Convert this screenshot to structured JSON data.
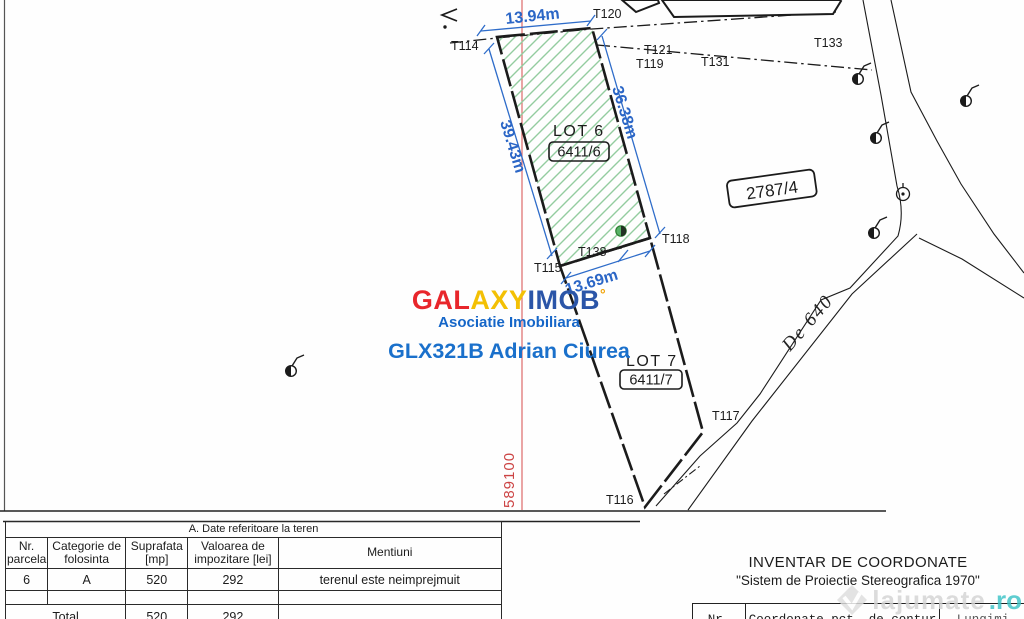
{
  "map": {
    "points": [
      {
        "id": "T114"
      },
      {
        "id": "T120"
      },
      {
        "id": "T121"
      },
      {
        "id": "T119"
      },
      {
        "id": "T131"
      },
      {
        "id": "T133"
      },
      {
        "id": "T138"
      },
      {
        "id": "T118"
      },
      {
        "id": "T115"
      },
      {
        "id": "T116"
      },
      {
        "id": "T117"
      }
    ],
    "dimensions": {
      "top": "13.94m",
      "left": "39.43m",
      "right": "36.38m",
      "bottom": "13.69m"
    },
    "lot6_label": "LOT 6",
    "lot6_parcel": "6411/6",
    "lot7_label": "LOT 7",
    "lot7_parcel": "6411/7",
    "parcel_right": "2787/4",
    "road_name": "De 640",
    "grid_coordinate": "589100"
  },
  "colors": {
    "hatch_green": "#93cc9f",
    "dimension_blue": "#2b66c6",
    "grid_red": "#cc4444",
    "brand_red": "#e8262b",
    "brand_yellow": "#f3c004",
    "brand_blue": "#2b55a8",
    "watermark_teal": "#3cc3c6"
  },
  "watermark": {
    "brand": [
      {
        "text": "GAL",
        "color": "#e8262b"
      },
      {
        "text": "AXY",
        "color": "#f3c004"
      },
      {
        "text": "IMOB",
        "color": "#2b55a8"
      }
    ],
    "brand_mark": "°",
    "subtitle": "Asociatie Imobiliara",
    "agent_code": "GLX321B Adrian Ciurea"
  },
  "land_table": {
    "section_title": "A. Date referitoare la teren",
    "headers": [
      "Nr.\nparcela",
      "Categorie de\nfolosinta",
      "Suprafata\n[mp]",
      "Valoarea de\nimpozitare [lei]",
      "Mentiuni"
    ],
    "row": {
      "nr": "6",
      "categorie": "A",
      "suprafata": "520",
      "valoare": "292",
      "mentiuni": "terenul este neimprejmuit"
    },
    "total": {
      "label": "Total",
      "suprafata": "520",
      "valoare": "292"
    }
  },
  "coord_inventory": {
    "title": "INVENTAR DE COORDONATE",
    "subtitle": "\"Sistem de Proiectie Stereografica 1970\"",
    "col_nr": "Nr.",
    "col_coords": "Coordonate pct. de contur",
    "col_lengths": "Lungimi"
  },
  "site_watermark": {
    "name": "lajumate",
    "tld": ".ro"
  }
}
